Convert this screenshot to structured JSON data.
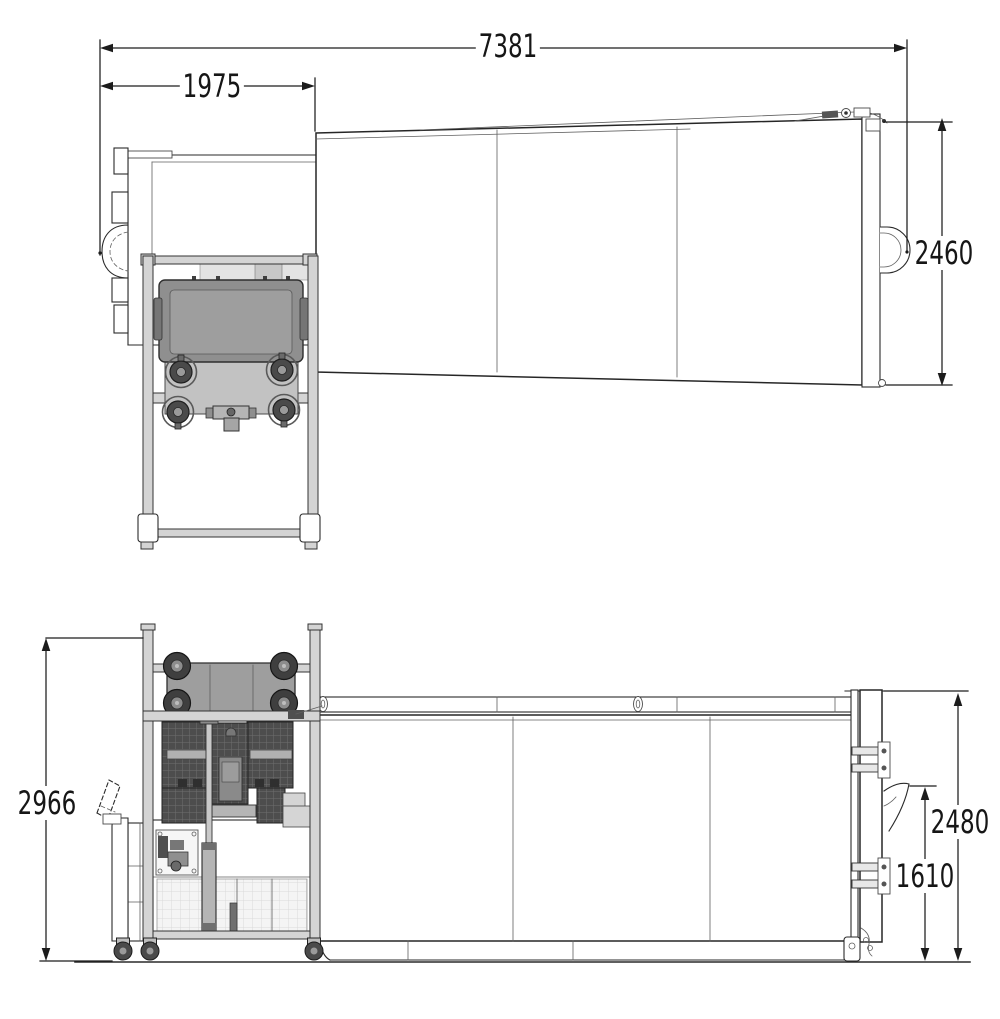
{
  "dimensions": {
    "overall_length": "7381",
    "bin_lifter_length": "1975",
    "container_height_top_view": "2460",
    "overall_height": "2966",
    "container_rear_height": "2480",
    "hook_height": "1610"
  },
  "colors": {
    "background": "#ffffff",
    "line": "#2a2a2a",
    "dimension": "#1c1c1c",
    "bin_gray": "#8f8f8f",
    "bin_light": "#9e9e9e",
    "hopper_dark": "#4d4d4d",
    "frame_gray": "#d4d4d4",
    "caster_dark": "#4a4a4a",
    "panel_light": "#f4f4f4"
  }
}
